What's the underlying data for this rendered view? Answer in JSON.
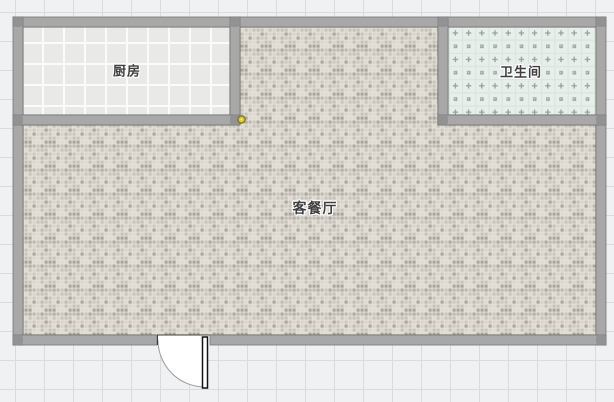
{
  "canvas": {
    "width_px": 614,
    "height_px": 402,
    "background_color": "#f0f1f2",
    "grid_color": "#d9dbdd",
    "grid_size_px": 29
  },
  "rooms": {
    "kitchen": {
      "label": "厨房",
      "floor_style": "white-large-tile",
      "floor_base_color": "#e9eae7",
      "grout_color": "#fbfbfa"
    },
    "bathroom": {
      "label": "卫生间",
      "floor_style": "green-dotted-tile",
      "floor_base_color": "#e6efe9",
      "grid_line_color": "#d9e4dd",
      "motif_color": "#96a19b"
    },
    "living_dining": {
      "label": "客餐厅",
      "floor_style": "beige-mosaic",
      "grout_color": "#e7e4dd",
      "mosaic_palette": [
        "#d8d4cb",
        "#c6c1b8",
        "#b3aea5",
        "#cdc8bf",
        "#bfbab1",
        "#aba69d",
        "#dedad2",
        "#c9c4bb"
      ]
    }
  },
  "walls": {
    "fill_color": "#a8a8a8",
    "edge_color": "#757575",
    "inner_line_color": "#3c3c3c",
    "corner_block_color": "#8f8f8f",
    "thickness_px": 10
  },
  "door": {
    "type": "single-swing-door",
    "leaf_color": "#ffffff",
    "leaf_outline_color": "#111111",
    "swing_arc_color": "#9b9b9b"
  },
  "selection_marker": {
    "shape": "circle",
    "fill_color": "#d9c832",
    "ring_color": "#7a6e1e"
  },
  "label_style": {
    "text_color": "#3f3f3f",
    "halo_color": "#ffffff"
  }
}
